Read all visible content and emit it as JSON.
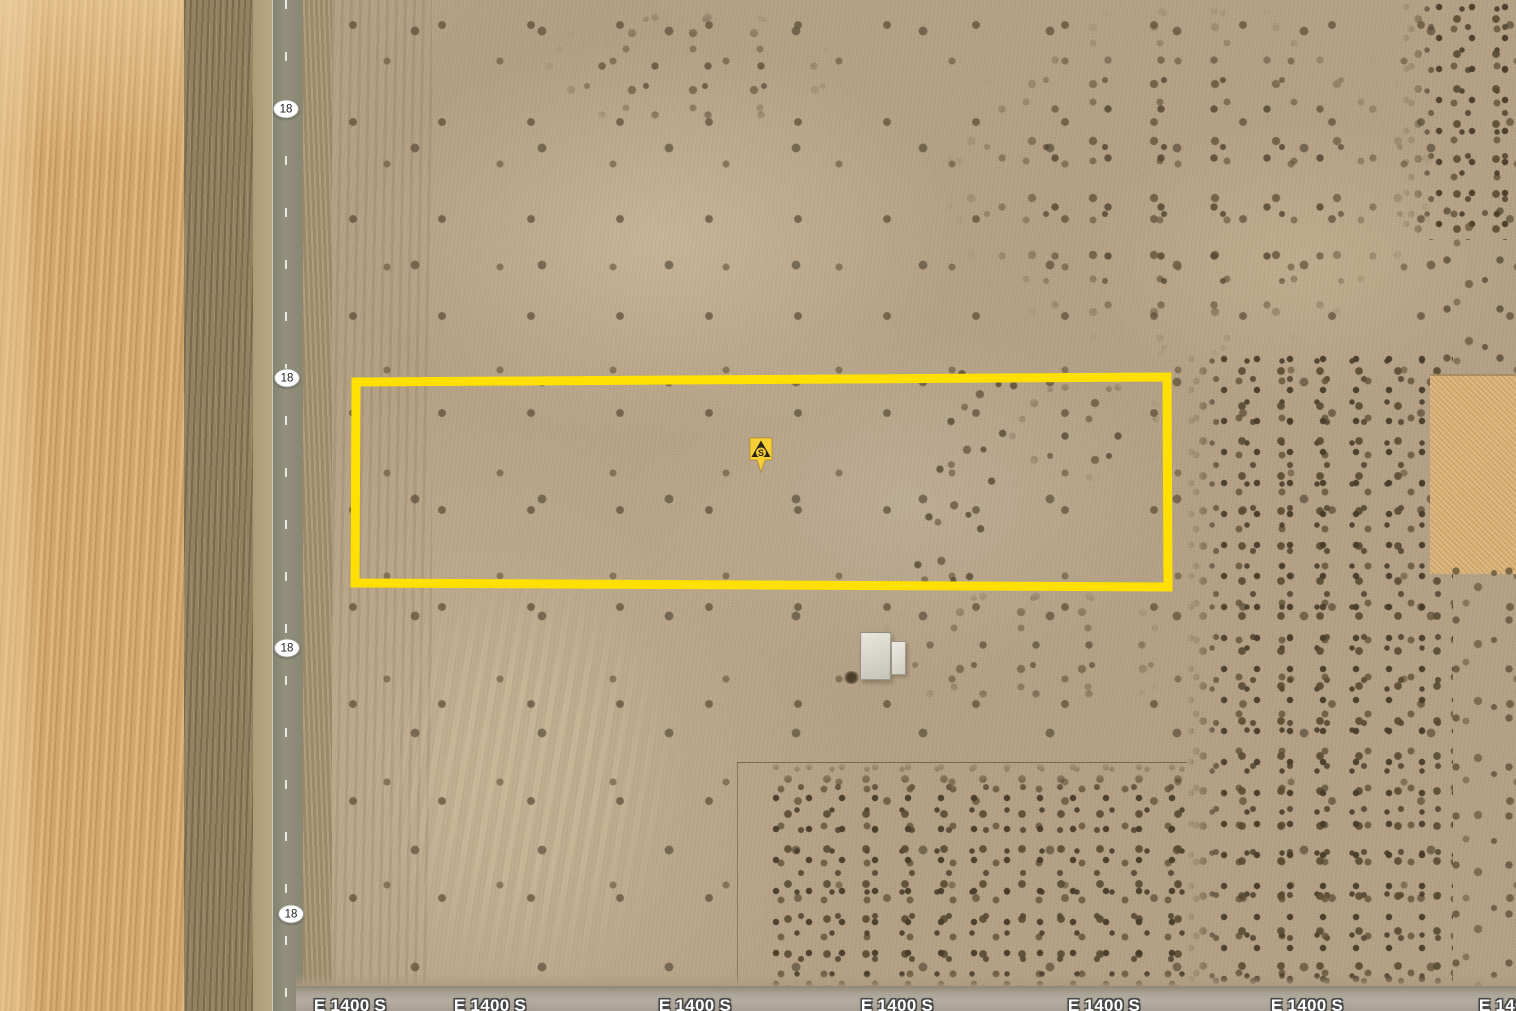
{
  "map": {
    "route_shields": [
      {
        "label": "18"
      },
      {
        "label": "18"
      },
      {
        "label": "18"
      },
      {
        "label": "18"
      }
    ],
    "road_labels": [
      {
        "text": "E 1400 S"
      },
      {
        "text": "E 1400 S"
      },
      {
        "text": "E 1400 S"
      },
      {
        "text": "E 1400 S"
      },
      {
        "text": "E 1400 S"
      },
      {
        "text": "E 1400 S"
      },
      {
        "text": "E 1400 S"
      }
    ],
    "parcel": {
      "outline_color": "#ffe000"
    },
    "marker": {
      "letter": "S",
      "fill": "#f7ce35",
      "glyph_color": "#2a2417"
    }
  }
}
